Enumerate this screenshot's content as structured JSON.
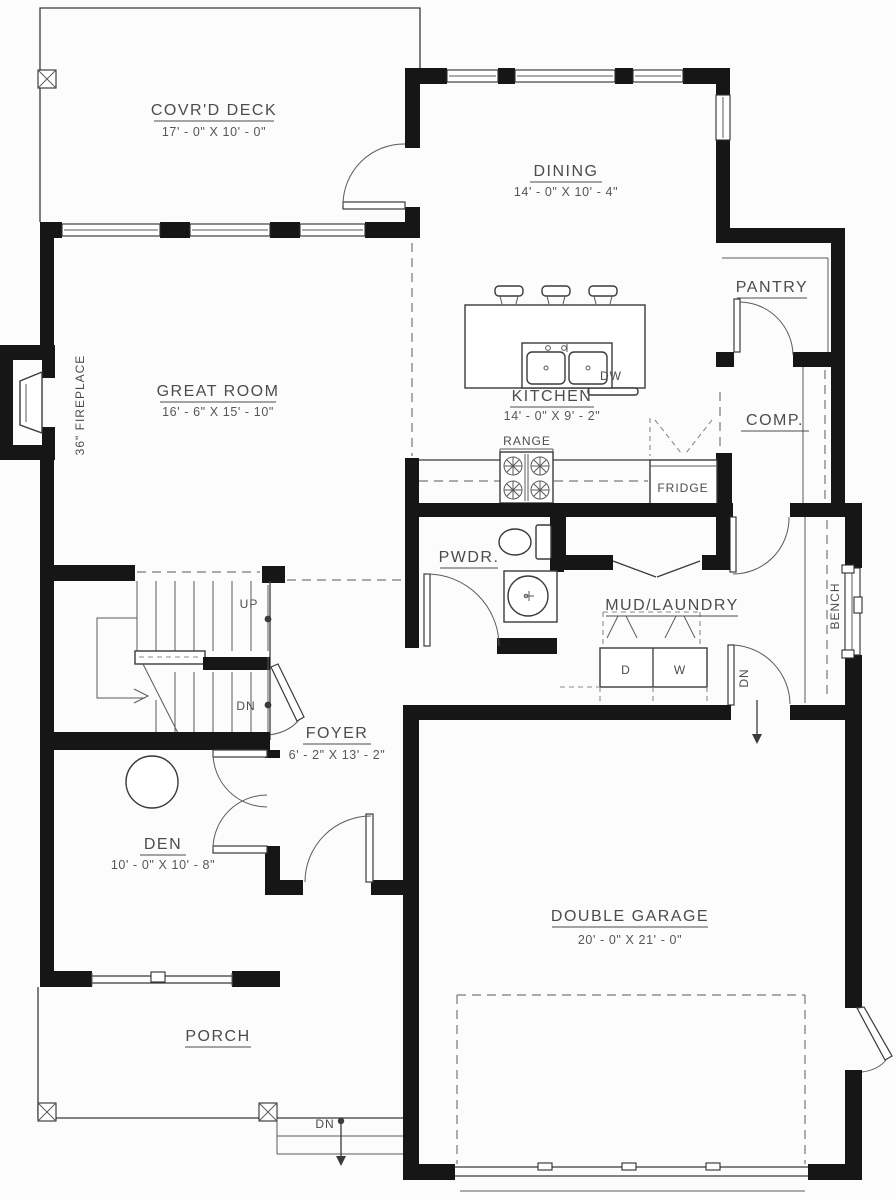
{
  "plan": {
    "rooms": {
      "covrd_deck": {
        "name": "COVR'D DECK",
        "dims": "17' - 0\" X 10' - 0\""
      },
      "dining": {
        "name": "DINING",
        "dims": "14' - 0\" X 10' - 4\""
      },
      "pantry": {
        "name": "PANTRY"
      },
      "comp": {
        "name": "COMP."
      },
      "great_room": {
        "name": "GREAT ROOM",
        "dims": "16' - 6\" X 15' - 10\""
      },
      "kitchen": {
        "name": "KITCHEN",
        "dims": "14' - 0\" X 9' - 2\""
      },
      "pwdr": {
        "name": "PWDR."
      },
      "mud_laundry": {
        "name": "MUD/LAUNDRY"
      },
      "foyer": {
        "name": "FOYER",
        "dims": "6' - 2\" X 13' - 2\""
      },
      "den": {
        "name": "DEN",
        "dims": "10' - 0\" X 10' - 8\""
      },
      "double_garage": {
        "name": "DOUBLE GARAGE",
        "dims": "20' - 0\" X 21' - 0\""
      },
      "porch": {
        "name": "PORCH"
      }
    },
    "fixtures": {
      "fireplace": "36\" FIREPLACE",
      "range": "RANGE",
      "fridge": "FRIDGE",
      "dishwasher": "DW",
      "bench": "BENCH",
      "dryer": "D",
      "washer": "W"
    },
    "annotations": {
      "stairs_up": "UP",
      "stairs_down": "DN",
      "garage_down": "DN",
      "porch_down": "DN"
    },
    "colors": {
      "wall": "#161616",
      "line": "#3a3a3a",
      "text": "#4c4c4c",
      "background": "#fcfcfc"
    }
  }
}
